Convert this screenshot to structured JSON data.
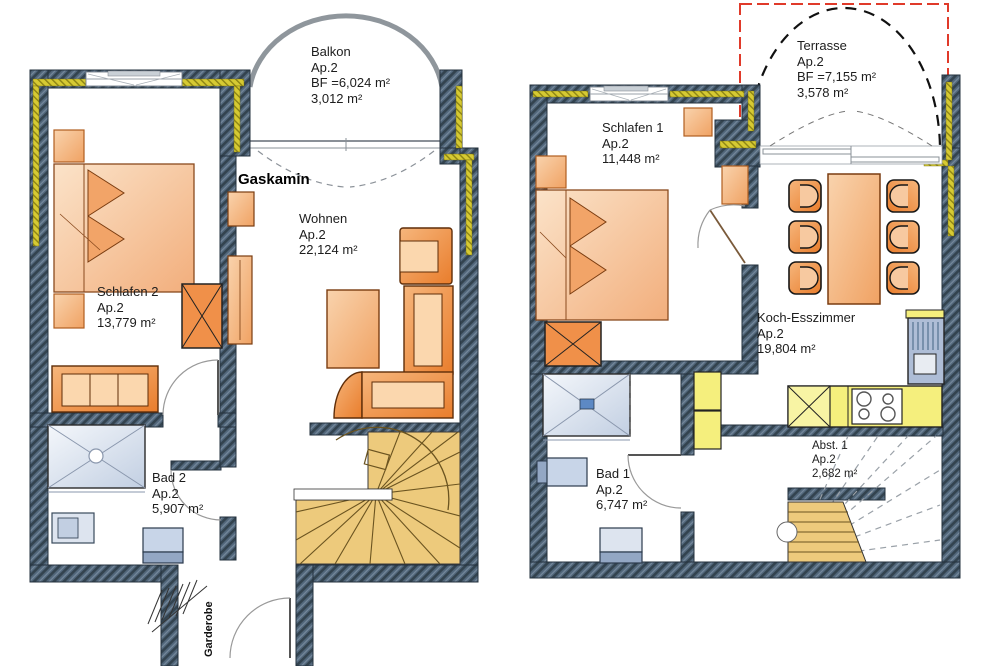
{
  "left_plan": {
    "balkon": {
      "title": "Balkon",
      "subtitle": "Ap.2",
      "line3": "BF =6,024 m²",
      "line4": "3,012 m²"
    },
    "gaskamin": "Gaskamin",
    "wohnen": {
      "title": "Wohnen",
      "subtitle": "Ap.2",
      "line3": "22,124 m²"
    },
    "schlafen2": {
      "title": "Schlafen 2",
      "subtitle": "Ap.2",
      "line3": "13,779 m²"
    },
    "bad2": {
      "title": "Bad 2",
      "subtitle": "Ap.2",
      "line3": "5,907 m²"
    },
    "garderobe": "Garderobe"
  },
  "right_plan": {
    "terrasse": {
      "title": "Terrasse",
      "subtitle": "Ap.2",
      "line3": "BF =7,155 m²",
      "line4": "3,578 m²"
    },
    "schlafen1": {
      "title": "Schlafen 1",
      "subtitle": "Ap.2",
      "line3": "11,448 m²"
    },
    "koch": {
      "title": "Koch-Esszimmer",
      "subtitle": "Ap.2",
      "line3": "19,804 m²"
    },
    "bad1": {
      "title": "Bad 1",
      "subtitle": "Ap.2",
      "line3": "6,747 m²"
    },
    "abst1": {
      "title": "Abst. 1",
      "subtitle": "Ap.2",
      "line3": "2,682 m²"
    }
  },
  "colors": {
    "wall": "#52677b",
    "insulation": "#d6ca33",
    "furniture_orange": "#ef9557",
    "stairs_tan": "#edca7c",
    "kitchen_yellow": "#f5ef7d",
    "sanitary_blue": "#c2cfe2",
    "terrace_outline_red": "#e03a2a"
  }
}
